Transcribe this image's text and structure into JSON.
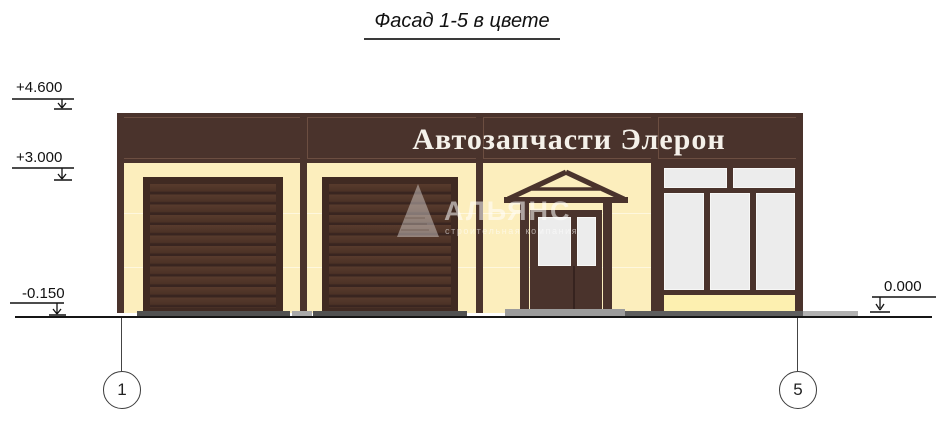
{
  "title": "Фасад 1-5 в цвете",
  "facade": {
    "sign_text": "Автозапчасти Элерон"
  },
  "elevation_marks": {
    "top": "+4.600",
    "middle": "+3.000",
    "ground_left": "-0.150",
    "ground_right": "0.000"
  },
  "axis_markers": {
    "left": "1",
    "right": "5"
  },
  "watermark": {
    "name": "АЛЬЯНС",
    "tagline": "строительная компания"
  },
  "colors": {
    "facade_brown": "#4a332c",
    "wall_cream": "#fceebd",
    "spandrel_yellow": "#fdf0b0",
    "glass_gray": "#ececec",
    "door_slat": "#4e3428",
    "ground_dark_gray": "#515151",
    "ground_mid_gray": "#9c9c9c",
    "ground_light_gray": "#b1b1b1"
  }
}
